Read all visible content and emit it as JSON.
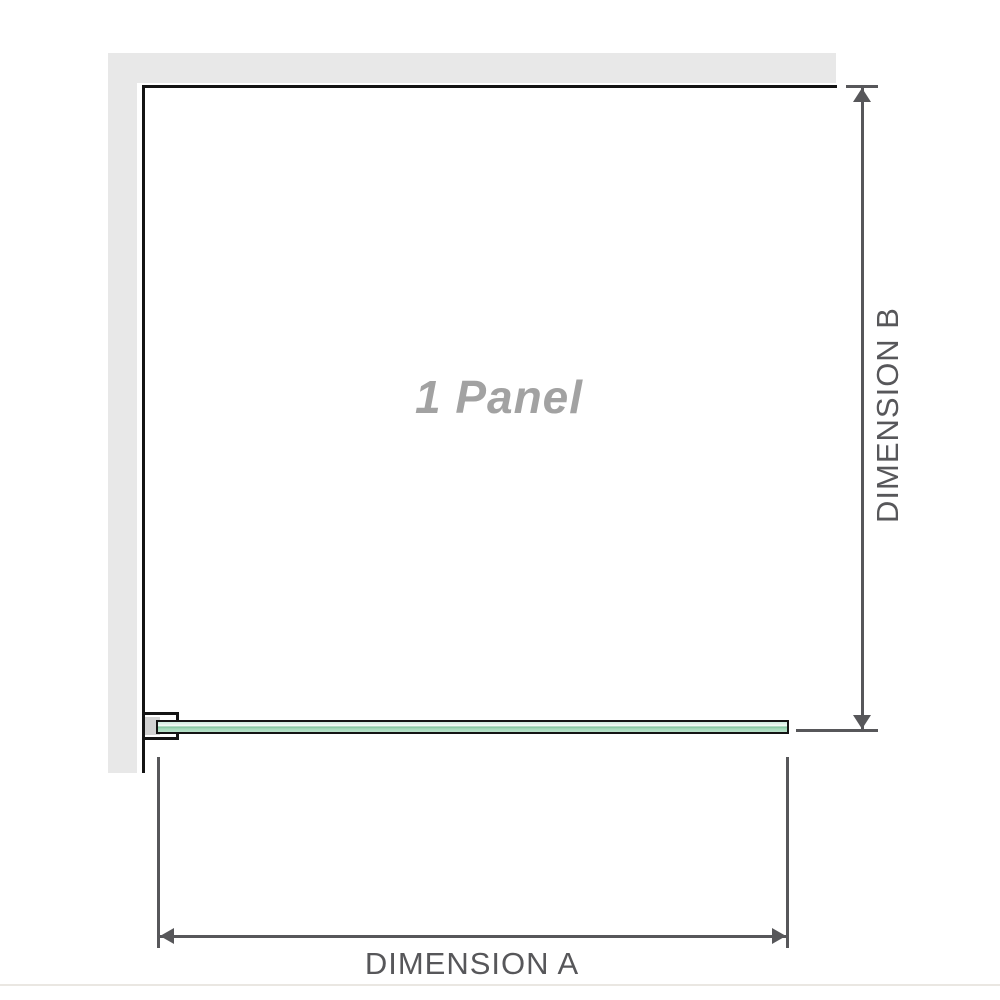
{
  "diagram": {
    "panel_label": "1 Panel",
    "dimension_a_label": "DIMENSION A",
    "dimension_b_label": "DIMENSION B"
  },
  "colors": {
    "wall_gray": "#e8e8e8",
    "outline_black": "#141414",
    "glass_green": "#a4d9ba",
    "glass_green_light": "#e9f6ee",
    "glass_green_dark": "#7fc49d",
    "bracket_gray": "#d2d2d2",
    "dimension_gray": "#57575a",
    "label_gray": "#a2a2a2",
    "baseline_beige": "#eae7e2"
  }
}
